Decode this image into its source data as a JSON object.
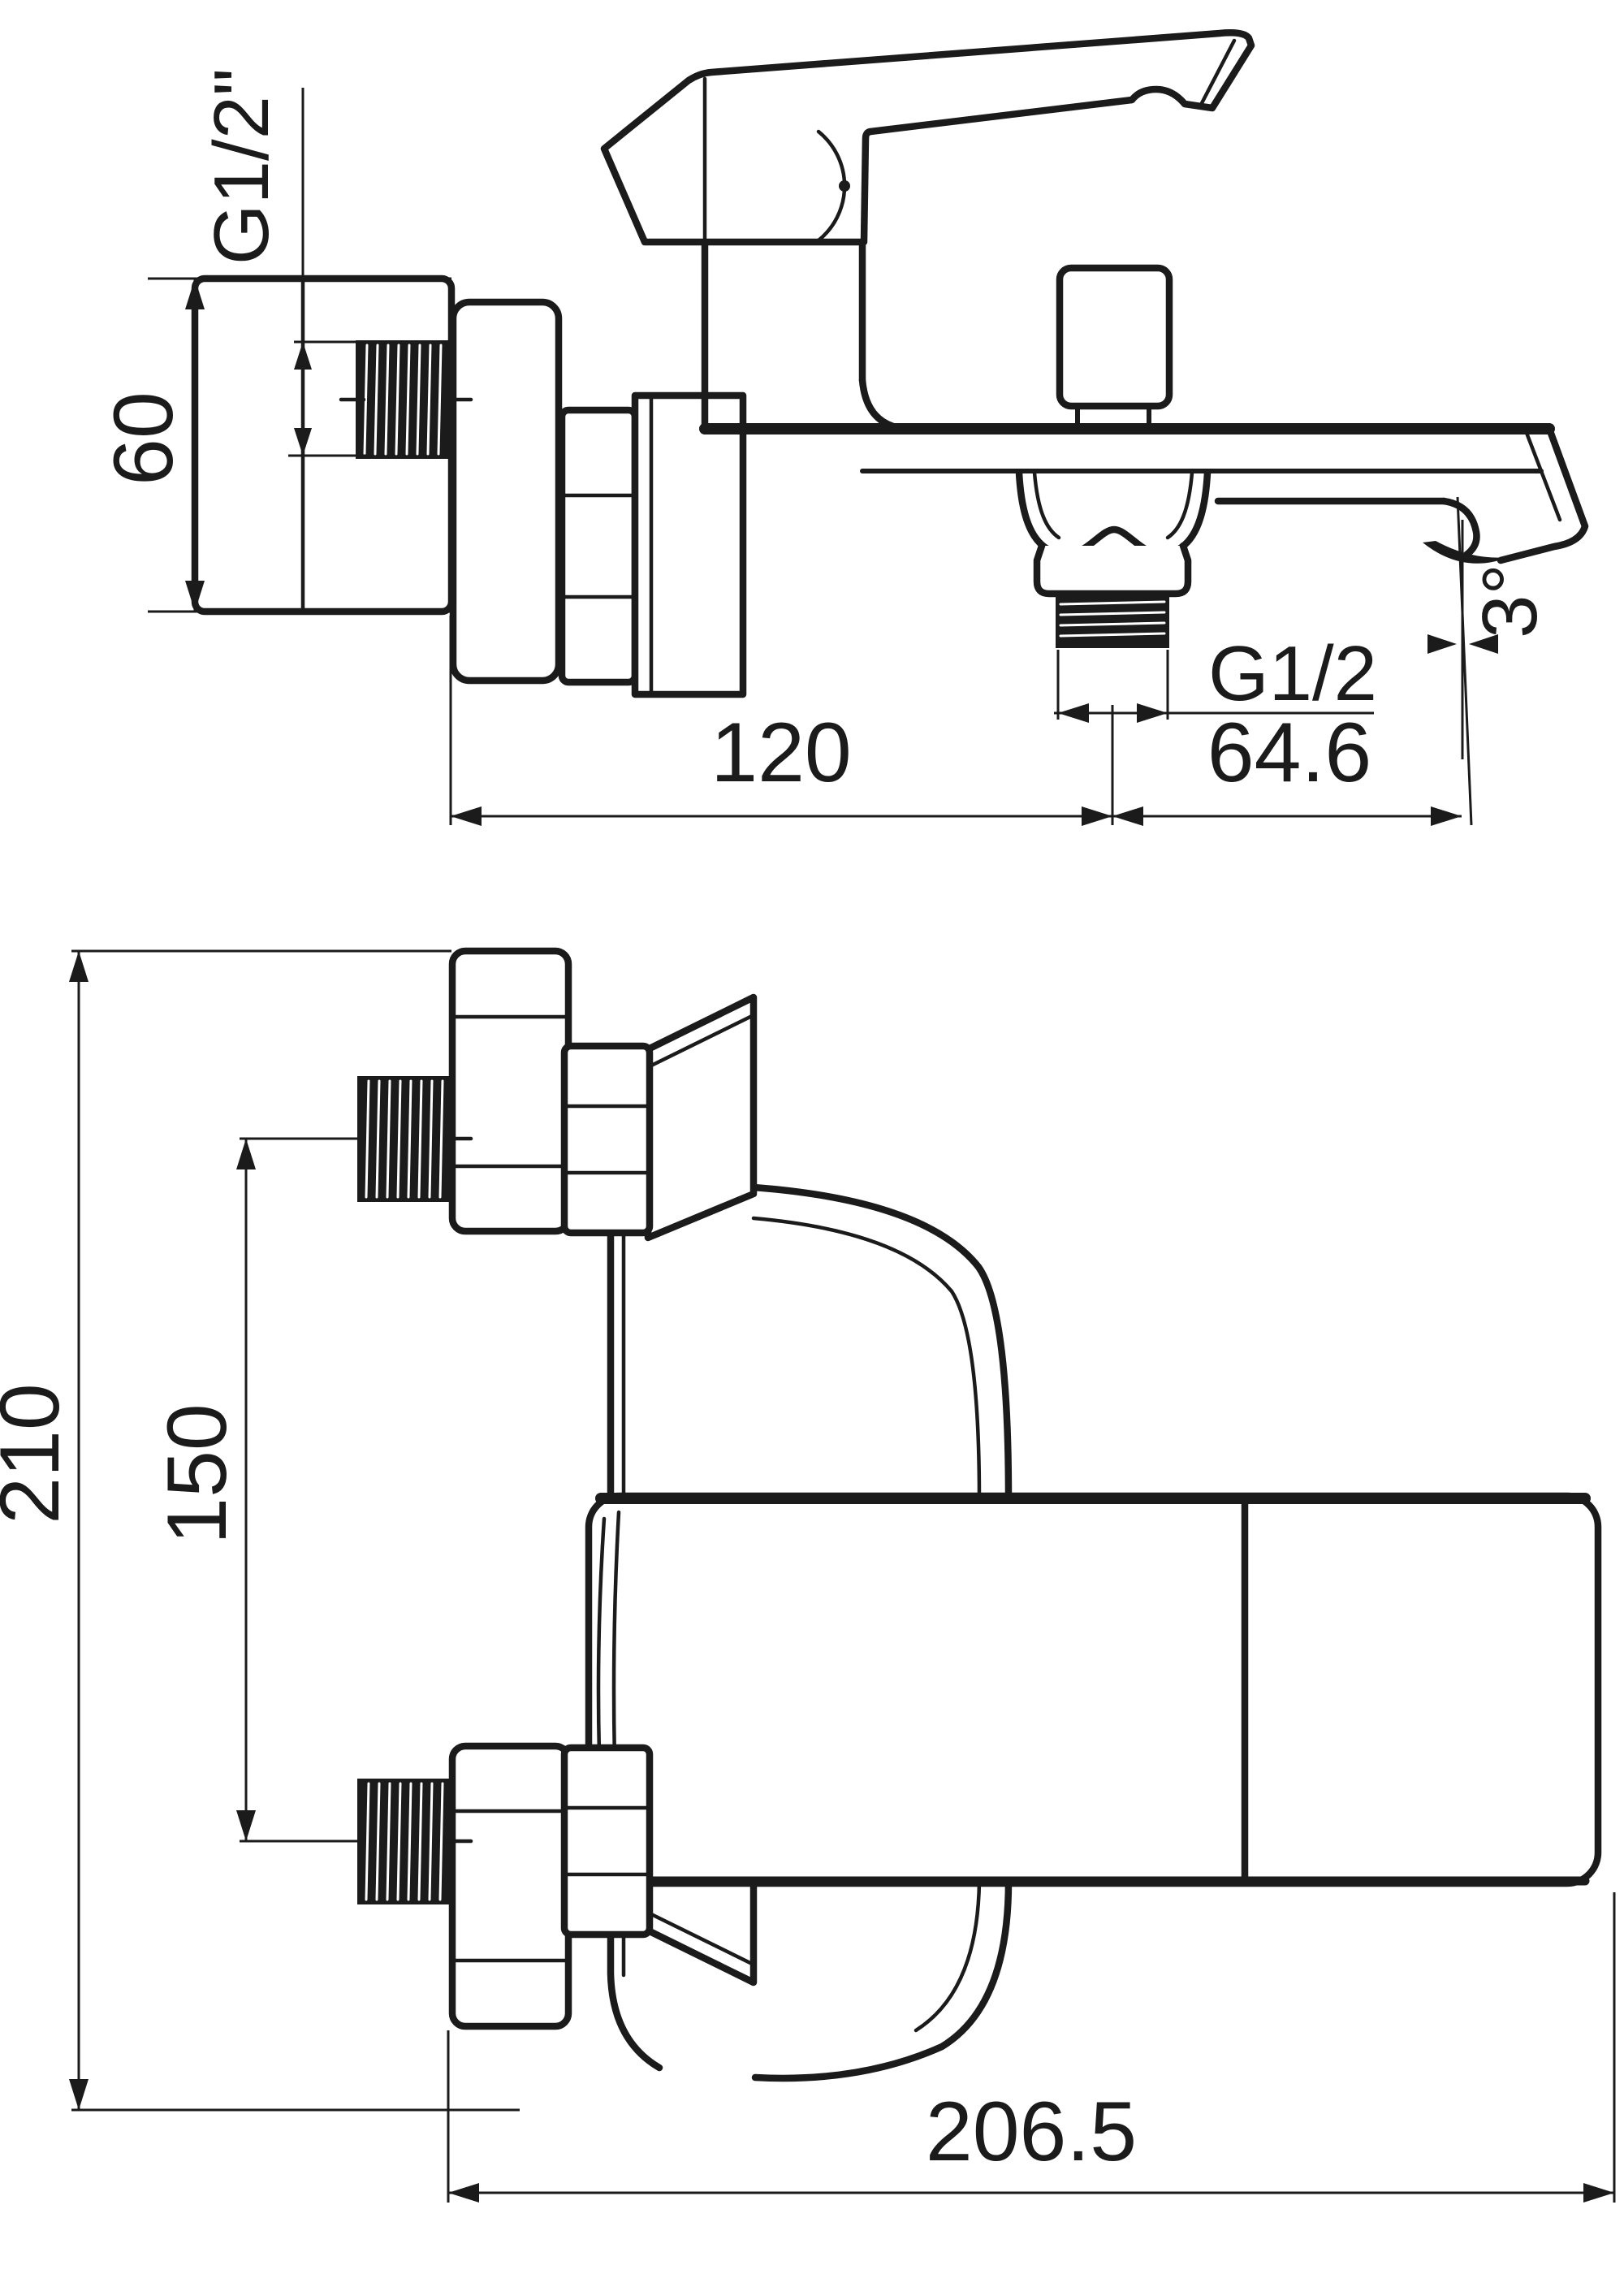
{
  "drawing": {
    "title": "bath-shower-mixer-installation-drawing",
    "background_color": "#ffffff",
    "line_color": "#1b1b1b",
    "views": [
      {
        "id": "side-view",
        "name": "side elevation with spout and diverter"
      },
      {
        "id": "front-view",
        "name": "front elevation with wall brackets"
      }
    ]
  },
  "labels": {
    "g12_wall": "G1/2\"",
    "h60": "60",
    "w120": "120",
    "w646": "64.6",
    "g12_outlet": "G1/2",
    "angle3": "3°",
    "h210": "210",
    "h150": "150",
    "w2065": "206.5"
  }
}
